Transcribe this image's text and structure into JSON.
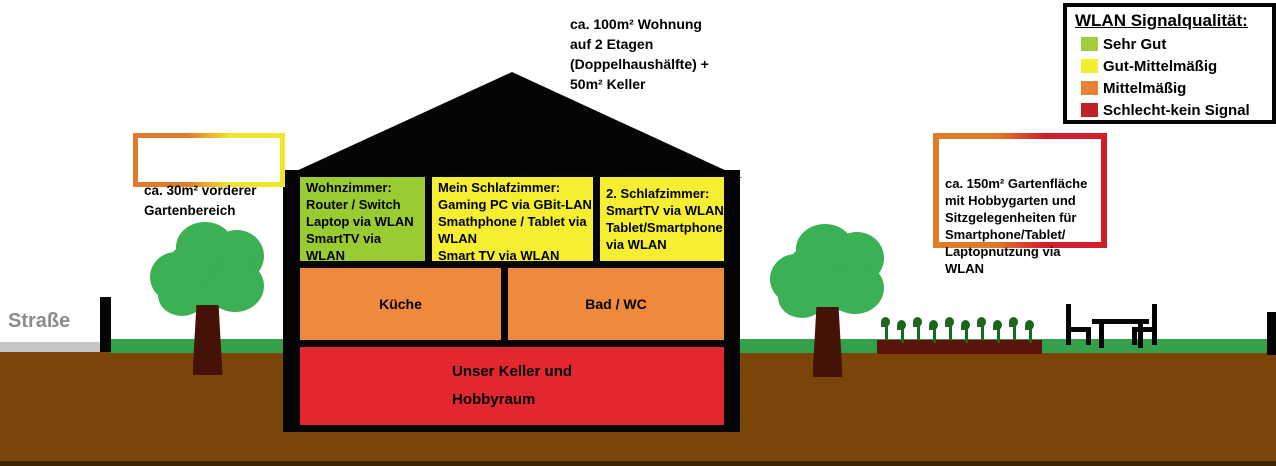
{
  "palette": {
    "signal_green": "#9ACC32",
    "signal_yellow": "#F5EE31",
    "signal_orange": "#EF8A3C",
    "signal_red": "#E2272E",
    "grass_green": "#35A04A",
    "tree_green": "#3CB054",
    "trunk_brown": "#451208",
    "soil_brown": "#7B4408",
    "soil_dark": "#3F2403",
    "bed_brown": "#5B130D",
    "plant_green": "#1E651E",
    "road_gray": "#C6C6C6",
    "street_text_gray": "#8C8C8C"
  },
  "top_note": {
    "text": "ca. 100m² Wohnung\nauf 2 Etagen\n(Doppelhaushälfte) +\n50m² Keller"
  },
  "front_garden_note": {
    "text": "ca. 30m² vorderer\nGartenbereich",
    "border_colors": [
      "#E07B2A",
      "#F2E62C"
    ]
  },
  "back_garden_note": {
    "text": "ca. 150m² Gartenfläche\nmit Hobbygarten und\nSitzgelegenheiten für\nSmartphone/Tablet/\nLaptopnutzung via\nWLAN",
    "border_colors": [
      "#E07B2A",
      "#D21E2B"
    ]
  },
  "street_label": "Straße",
  "legend": {
    "title": "WLAN Signalqualität:",
    "items": [
      {
        "label": "Sehr Gut",
        "color": "#A3CB3B"
      },
      {
        "label": "Gut-Mittelmäßig",
        "color": "#F4EE33"
      },
      {
        "label": "Mittelmäßig",
        "color": "#E98136"
      },
      {
        "label": "Schlecht-kein Signal",
        "color": "#C02128"
      }
    ]
  },
  "house": {
    "rooms": [
      {
        "name": "Wohnzimmer",
        "color": "#9ACC32",
        "text": "Wohnzimmer:\nRouter / Switch\nLaptop via WLAN\nSmartTV via\nWLAN"
      },
      {
        "name": "Mein Schlafzimmer",
        "color": "#F5EE31",
        "text": "Mein Schlafzimmer:\nGaming PC via GBit-LAN\nSmathphone / Tablet via\nWLAN\nSmart TV via WLAN"
      },
      {
        "name": "2. Schlafzimmer",
        "color": "#F5EE31",
        "text": "2. Schlafzimmer:\nSmartTV via WLAN\nTablet/Smartphone\nvia WLAN"
      },
      {
        "name": "Küche",
        "color": "#EF8A3C",
        "text": "Küche"
      },
      {
        "name": "Bad / WC",
        "color": "#EF8A3C",
        "text": "Bad / WC"
      },
      {
        "name": "Keller",
        "color": "#E2272E",
        "text": "Unser Keller und\nHobbyraum"
      }
    ]
  }
}
